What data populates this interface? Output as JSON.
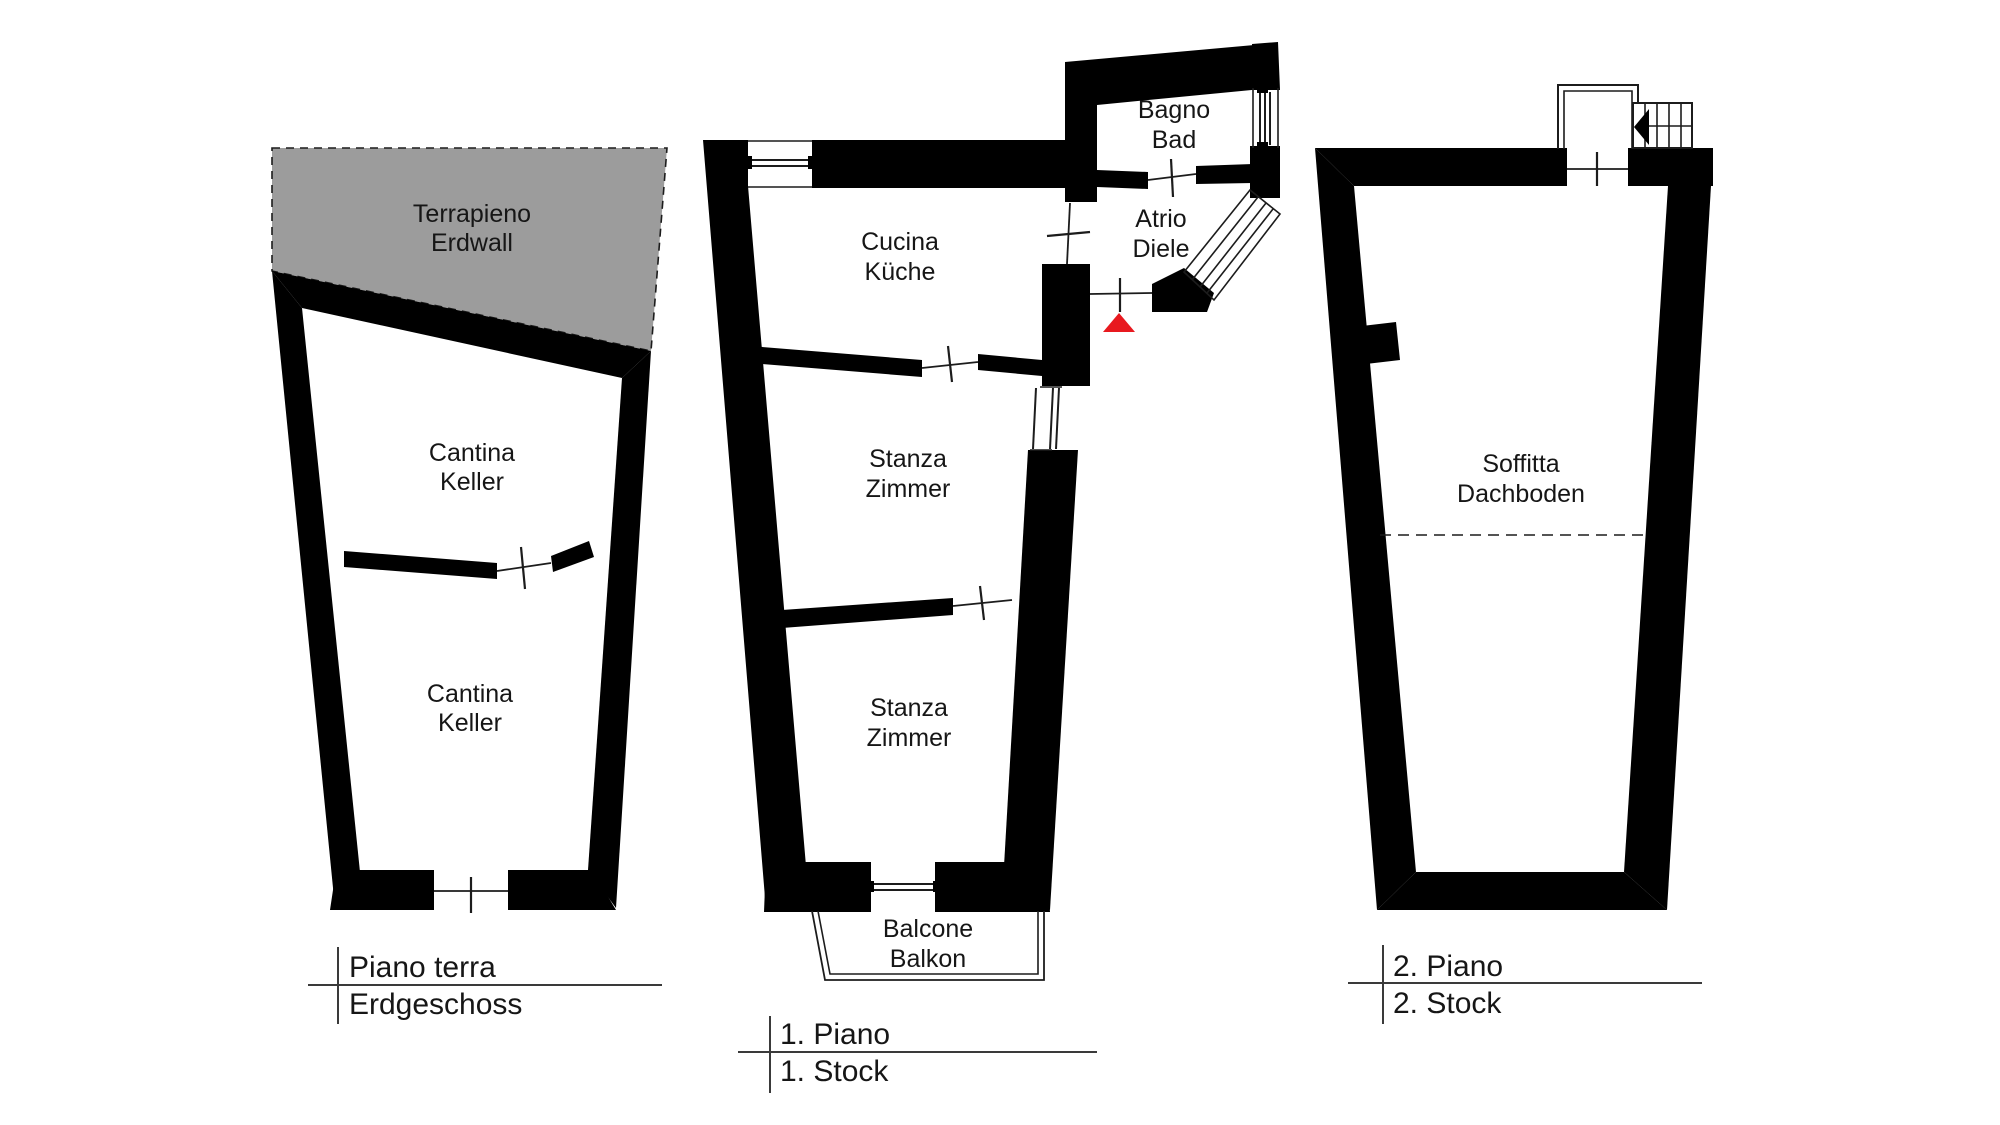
{
  "colors": {
    "wall": "#000000",
    "terrain_fill": "#9c9c9c",
    "entrance_marker": "#e8191f",
    "background": "#ffffff"
  },
  "plans": [
    {
      "name": "ground-floor",
      "floor_label": {
        "line1": "Piano terra",
        "line2": "Erdgeschoss"
      },
      "rooms": [
        {
          "it": "Terrapieno",
          "de": "Erdwall"
        },
        {
          "it": "Cantina",
          "de": "Keller"
        },
        {
          "it": "Cantina",
          "de": "Keller"
        }
      ]
    },
    {
      "name": "first-floor",
      "floor_label": {
        "line1": "1. Piano",
        "line2": "1. Stock"
      },
      "rooms": [
        {
          "it": "Cucina",
          "de": "Küche"
        },
        {
          "it": "Bagno",
          "de": "Bad"
        },
        {
          "it": "Atrio",
          "de": "Diele"
        },
        {
          "it": "Stanza",
          "de": "Zimmer"
        },
        {
          "it": "Stanza",
          "de": "Zimmer"
        },
        {
          "it": "Balcone",
          "de": "Balkon"
        }
      ]
    },
    {
      "name": "second-floor",
      "floor_label": {
        "line1": "2. Piano",
        "line2": "2. Stock"
      },
      "rooms": [
        {
          "it": "Soffitta",
          "de": "Dachboden"
        }
      ]
    }
  ]
}
